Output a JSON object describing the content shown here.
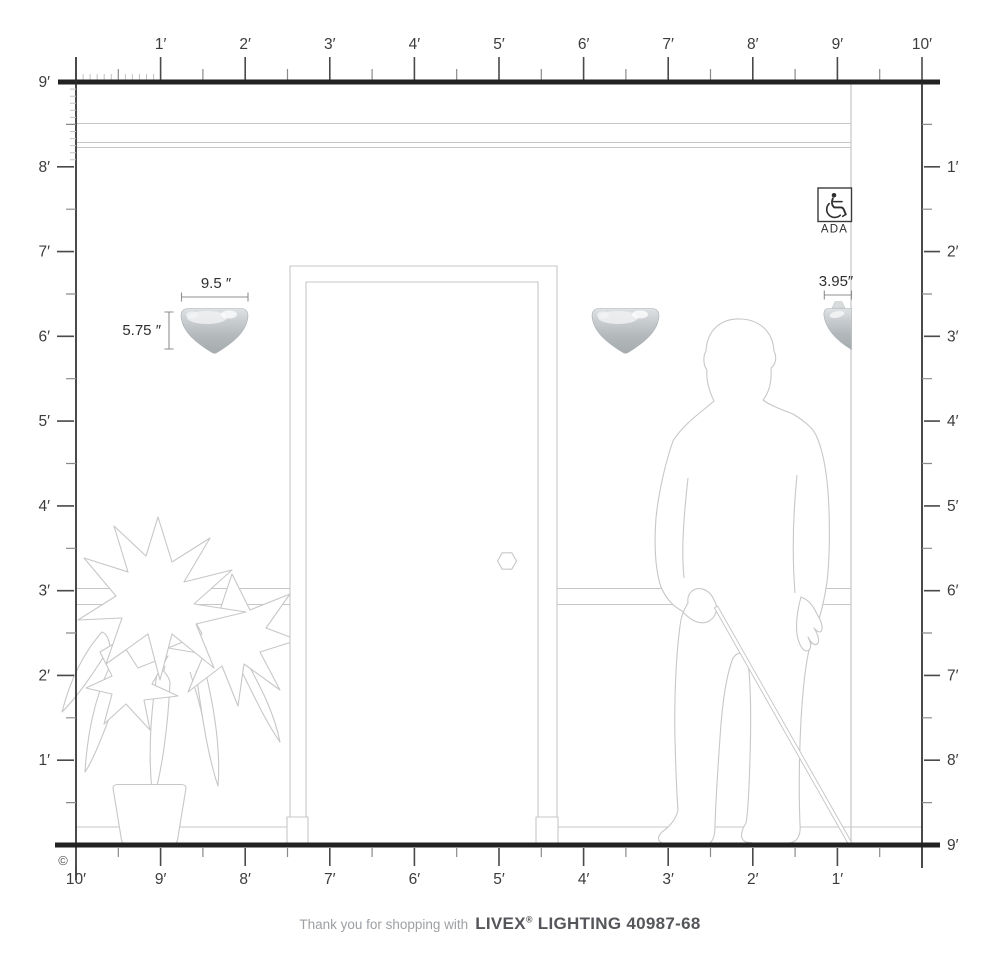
{
  "rulers": {
    "top": [
      "1′",
      "2′",
      "3′",
      "4′",
      "5′",
      "6′",
      "7′",
      "8′",
      "9′",
      "10′"
    ],
    "left": [
      "9′",
      "8′",
      "7′",
      "6′",
      "5′",
      "4′",
      "3′",
      "2′",
      "1′"
    ],
    "right": [
      "1′",
      "2′",
      "3′",
      "4′",
      "5′",
      "6′",
      "7′",
      "8′",
      "9′"
    ],
    "bottom": [
      "10′",
      "9′",
      "8′",
      "7′",
      "6′",
      "5′",
      "4′",
      "3′",
      "2′",
      "1′"
    ]
  },
  "dimensions": {
    "sconce_width": "9.5 ″",
    "sconce_height": "5.75 ″",
    "sconce_projection": "3.95″"
  },
  "ada_badge": {
    "label": "ADA",
    "icon": "wheelchair-icon"
  },
  "copyright_mark": "©",
  "footer": {
    "prefix": "Thank you for shopping with",
    "brand": "LIVEX",
    "registered": "®",
    "model": "LIGHTING 40987-68"
  },
  "colors": {
    "ruler_line": "#222222",
    "tick_major": "#4a4a4a",
    "tick_minor": "#8a8a8a",
    "drawing_line": "#c7c7c7",
    "sconce_top": "#dfe2e3",
    "sconce_bottom": "#a6abae",
    "label_text": "#3c3c3c",
    "footer_muted": "#9da0a3",
    "footer_brand": "#55565a"
  }
}
